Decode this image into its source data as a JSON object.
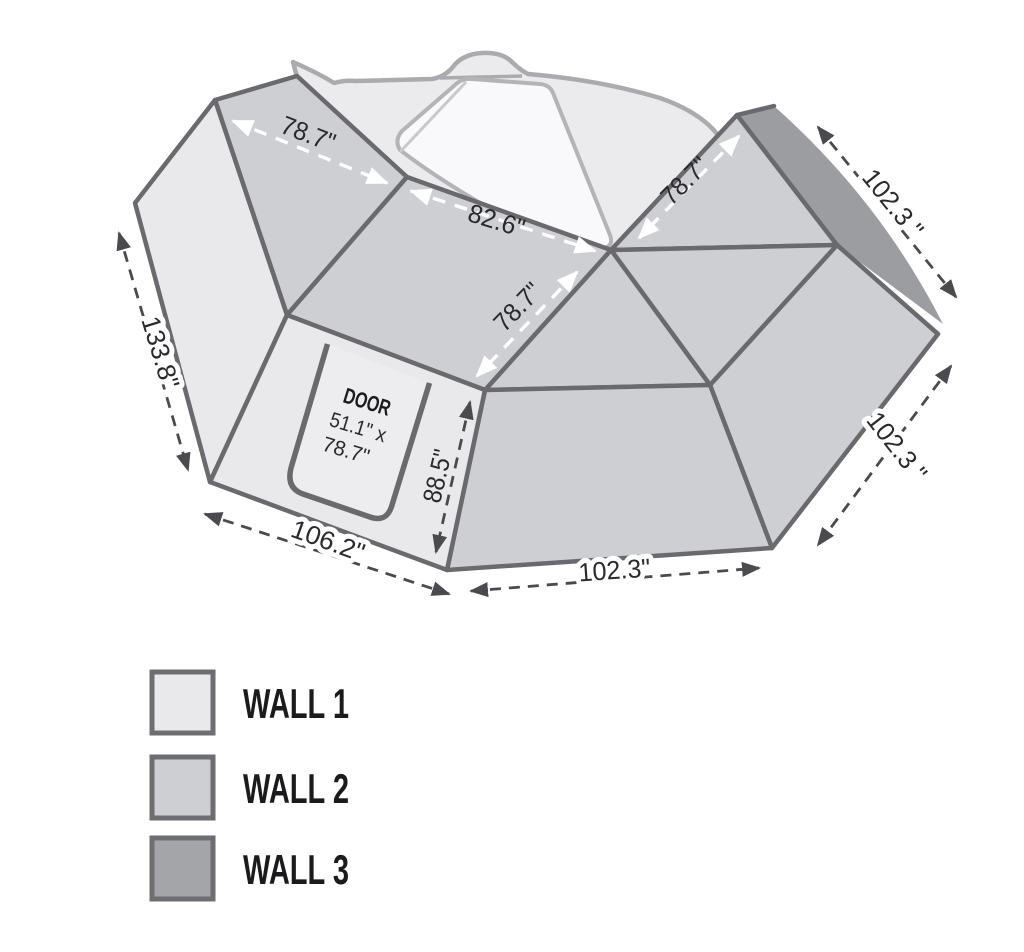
{
  "colors": {
    "wall1": "#e9e9ec",
    "wall2": "#cecfd3",
    "wall3": "#9c9da1",
    "panel_outline": "#6a6a6e",
    "dimension_line": "#4b4b4f",
    "dimension_white": "#ffffff",
    "vehicle_fill": "#ebebee",
    "vehicle_outline": "#ababaf",
    "window_fill": "#f9f9fb",
    "text": "#2a2a2d"
  },
  "dimensions": {
    "roof_left": {
      "label": "78.7\""
    },
    "roof_middle": {
      "label": "82.6\""
    },
    "middle_diagonal": {
      "label": "78.7\""
    },
    "right_diagonal": {
      "label": "78.7\""
    },
    "rear_top_edge": {
      "label": "102.3 \""
    },
    "rear_side_edge": {
      "label": "102.3 \""
    },
    "rear_bottom_edge": {
      "label": "102.3\""
    },
    "door_wall_height": {
      "label": "88.5\""
    },
    "front_bottom_edge": {
      "label": "106.2\""
    },
    "left_wall_slant": {
      "label": "133.8\""
    }
  },
  "door": {
    "title": "DOOR",
    "size_line1": "51.1\" x",
    "size_line2": "78.7\""
  },
  "legend": {
    "items": [
      {
        "label": "WALL 1",
        "color": "#e9e9ec"
      },
      {
        "label": "WALL 2",
        "color": "#cecfd3"
      },
      {
        "label": "WALL 3",
        "color": "#a4a5a9"
      }
    ]
  }
}
